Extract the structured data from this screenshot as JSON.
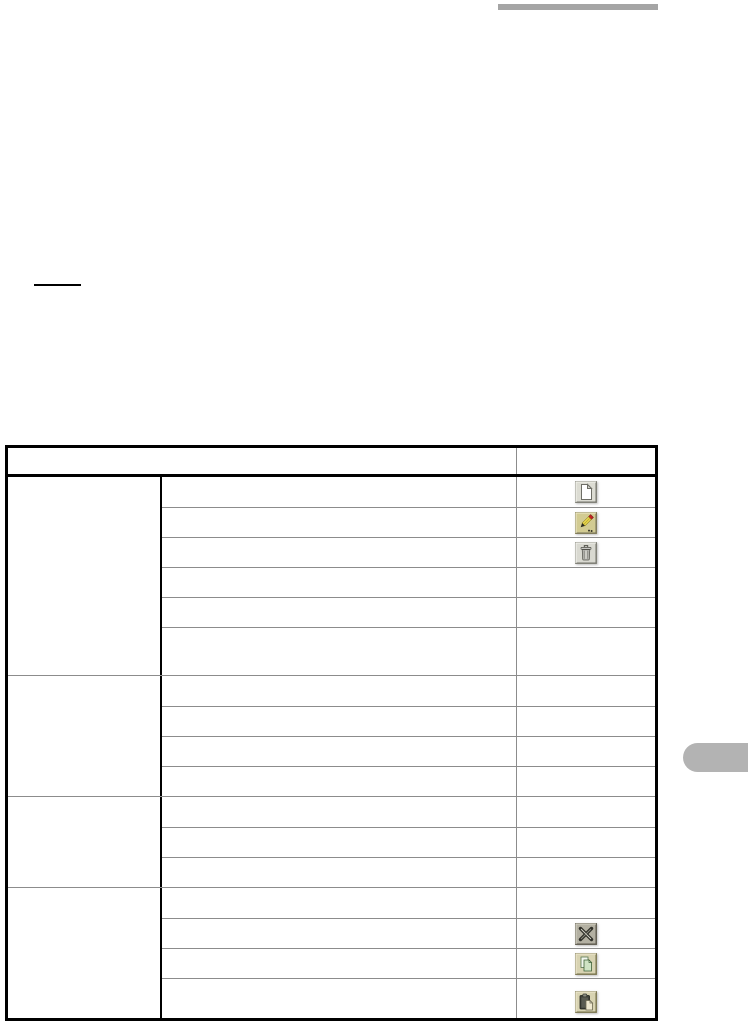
{
  "page": {
    "background": "#ffffff"
  },
  "decorations": {
    "top_bar_color": "#a5a5a5",
    "rule_mark_color": "#000000",
    "side_tab_color": "#b3b3b3"
  },
  "table": {
    "border_color": "#000000",
    "grid_color": "#8c8c8c",
    "header": {
      "description_label": "",
      "icon_column_label": ""
    },
    "groups": [
      {
        "rows": [
          {
            "icon": "new-document"
          },
          {
            "icon": "edit-pencil"
          },
          {
            "icon": "delete-trash"
          },
          {
            "icon": null
          },
          {
            "icon": null
          },
          {
            "icon": null,
            "tall": 48
          }
        ]
      },
      {
        "rows": [
          {
            "icon": null
          },
          {
            "icon": null
          },
          {
            "icon": null
          },
          {
            "icon": null
          }
        ]
      },
      {
        "rows": [
          {
            "icon": null
          },
          {
            "icon": null
          },
          {
            "icon": null
          }
        ]
      },
      {
        "rows": [
          {
            "icon": null
          },
          {
            "icon": "cut-scissors"
          },
          {
            "icon": "copy"
          },
          {
            "icon": "paste",
            "tall": 46
          }
        ]
      }
    ]
  },
  "icon_tiles": {
    "new-document": {
      "tile": "#dcdcd3",
      "page": "#ffffff"
    },
    "edit-pencil": {
      "tile": "#d2cb92",
      "body": "#ead94e",
      "eraser": "#c32222"
    },
    "delete-trash": {
      "tile": "#d9d9d1",
      "can": "#b9b9b4"
    },
    "cut-scissors": {
      "tile": "#b3b0a2",
      "blades": "#30302a"
    },
    "copy": {
      "tile": "#d8d3b2",
      "pages": "#cfe3c4"
    },
    "paste": {
      "tile": "#d8d3b2",
      "board": "#3f413a",
      "sheet": "#efe9d0"
    }
  }
}
